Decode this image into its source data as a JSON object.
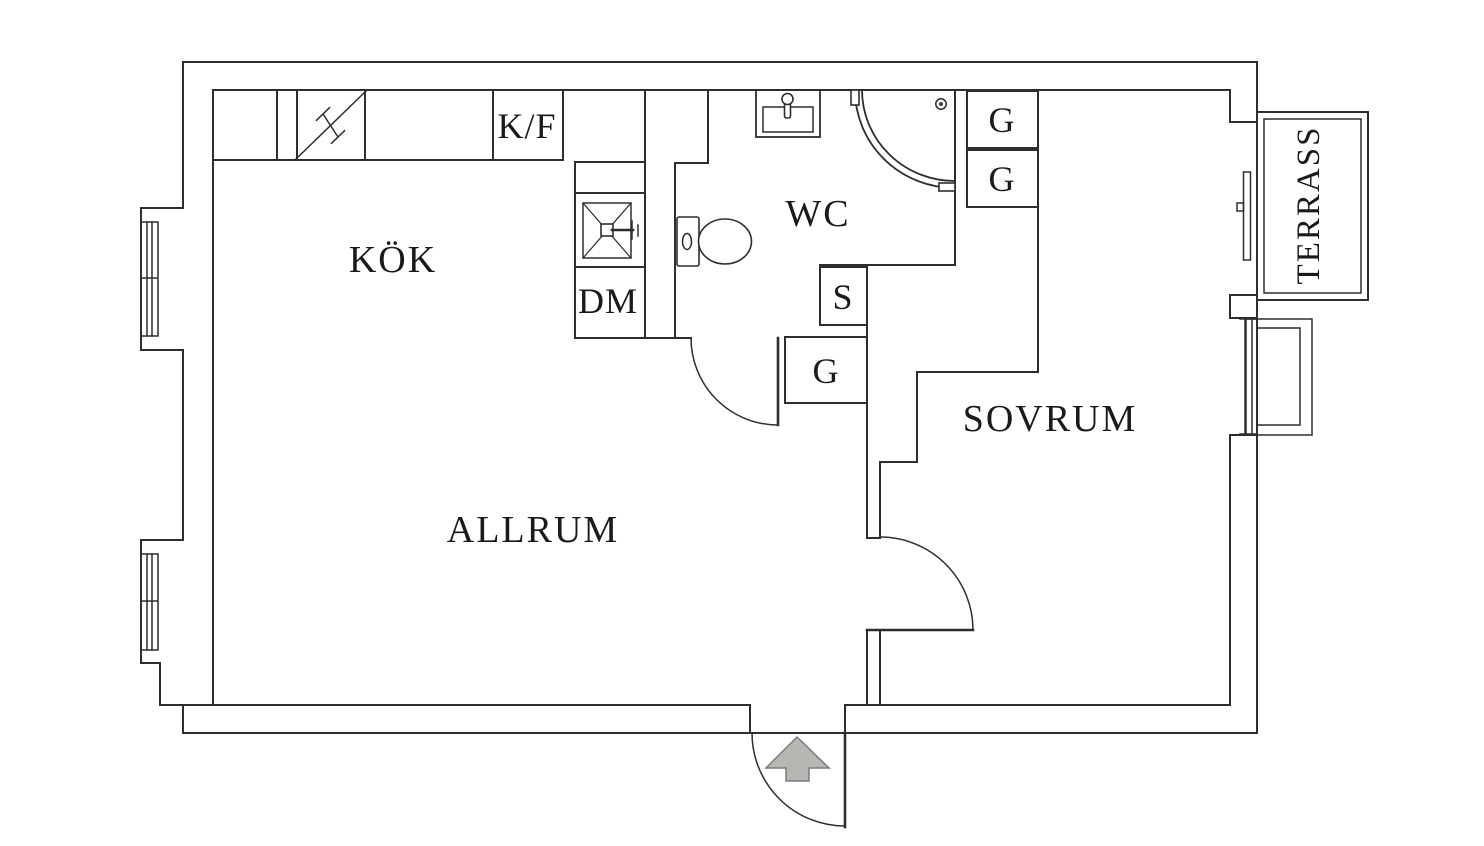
{
  "rooms": {
    "kitchen": {
      "label": "KÖK"
    },
    "wc": {
      "label": "WC"
    },
    "living_room": {
      "label": "ALLRUM"
    },
    "bedroom": {
      "label": "SOVRUM"
    },
    "terrace": {
      "label": "TERRASS"
    }
  },
  "fixtures": {
    "fridge_freezer": {
      "label": "K/F"
    },
    "dishwasher": {
      "label": "DM"
    },
    "closet_s": {
      "label": "S"
    },
    "closet_hall_g": {
      "label": "G"
    },
    "closet_bedroom_g1": {
      "label": "G"
    },
    "closet_bedroom_g2": {
      "label": "G"
    }
  },
  "icons": {
    "entrance_arrow": "up-arrow"
  },
  "colors": {
    "line": "#2e2e2e",
    "text": "#1a1a1a",
    "arrow_fill": "#b6b6b3",
    "arrow_stroke": "#7c7c7a",
    "background": "#ffffff"
  }
}
